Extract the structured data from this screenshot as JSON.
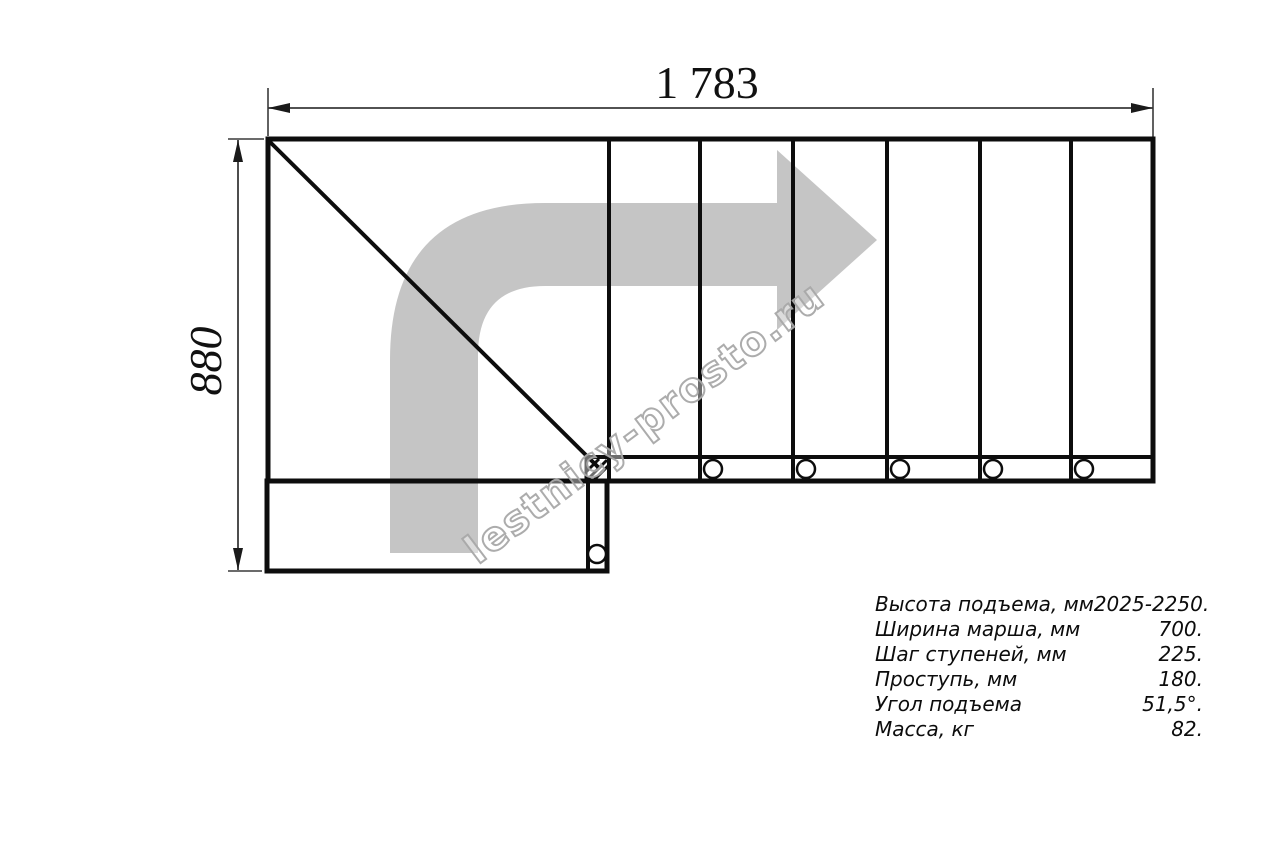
{
  "diagram": {
    "title_hint": "staircase plan view",
    "top_dimension_label": "1 783",
    "left_dimension_label": "880",
    "watermark_text": "lestnicy-prosto.ru"
  },
  "specs": {
    "rows": [
      {
        "label": "Высота подъема, мм",
        "value": "2025-2250."
      },
      {
        "label": "Ширина марша, мм",
        "value": "700."
      },
      {
        "label": "Шаг ступеней, мм",
        "value": "225."
      },
      {
        "label": "Проступь, мм",
        "value": "180."
      },
      {
        "label": "Угол подъема",
        "value": "51,5°."
      },
      {
        "label": "Масса, кг",
        "value": "82."
      }
    ]
  },
  "colors": {
    "line": "#0d0d0d",
    "dimension_line": "#3a3a3a",
    "arrow_fill": "#c5c5c5",
    "watermark_stroke": "#a8a8a8"
  }
}
